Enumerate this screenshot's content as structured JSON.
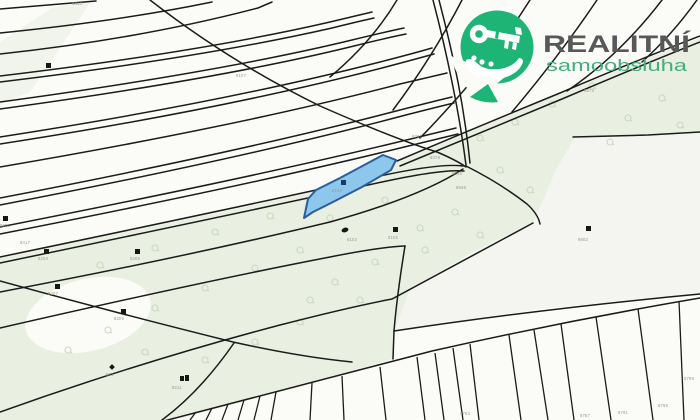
{
  "brand": {
    "name": "REALITNÍ",
    "subtitle": "samoobsluha",
    "logo_icon": "key-in-hand-icon"
  },
  "colors": {
    "background": "#fbfbf8",
    "land_green": "#e9efe1",
    "land_green_soft": "#eef2e6",
    "right_field_gray": "#f4f4f0",
    "line_dark": "#1b1b1b",
    "parcel_fill": "#8ec7ec",
    "parcel_stroke": "#2b5d9e",
    "parcel_marker": "#1d3a6e",
    "marker_black": "#161616",
    "label_gray": "#9a9a94",
    "veg_green": "#c9d6bb",
    "brand_green": "#1eb476",
    "brand_gray": "#58585a",
    "brand_subtitle_green": "#43ae7f"
  },
  "map": {
    "highlighted_parcel": {
      "label": "8106"
    },
    "parcel_labels": [
      {
        "text": "8313",
        "x": 72,
        "y": 5
      },
      {
        "text": "8107",
        "x": 236,
        "y": 77
      },
      {
        "text": "8737",
        "x": 412,
        "y": 138
      },
      {
        "text": "8379",
        "x": 430,
        "y": 159
      },
      {
        "text": "8635",
        "x": 452,
        "y": 175
      },
      {
        "text": "8596",
        "x": 456,
        "y": 189
      },
      {
        "text": "8573",
        "x": 584,
        "y": 92
      },
      {
        "text": "8802",
        "x": 578,
        "y": 241
      },
      {
        "text": "8106",
        "x": 332,
        "y": 192
      },
      {
        "text": "8103",
        "x": 347,
        "y": 241
      },
      {
        "text": "8105",
        "x": 388,
        "y": 239
      },
      {
        "text": "8417",
        "x": 20,
        "y": 244
      },
      {
        "text": "8201",
        "x": 0,
        "y": 227
      },
      {
        "text": "8203",
        "x": 38,
        "y": 260
      },
      {
        "text": "8205",
        "x": 130,
        "y": 260
      },
      {
        "text": "8207",
        "x": 48,
        "y": 295
      },
      {
        "text": "8209",
        "x": 114,
        "y": 320
      },
      {
        "text": "861",
        "x": 106,
        "y": 376
      },
      {
        "text": "8211",
        "x": 172,
        "y": 389
      },
      {
        "text": "8783",
        "x": 460,
        "y": 415
      },
      {
        "text": "8787",
        "x": 580,
        "y": 417
      },
      {
        "text": "8791",
        "x": 618,
        "y": 414
      },
      {
        "text": "8795",
        "x": 658,
        "y": 407
      },
      {
        "text": "8799",
        "x": 684,
        "y": 380
      }
    ],
    "building_markers": [
      {
        "kind": "square",
        "x": 46,
        "y": 63
      },
      {
        "kind": "square",
        "x": 3,
        "y": 216
      },
      {
        "kind": "square",
        "x": 44,
        "y": 249
      },
      {
        "kind": "square",
        "x": 135,
        "y": 249
      },
      {
        "kind": "square",
        "x": 55,
        "y": 284
      },
      {
        "kind": "square",
        "x": 121,
        "y": 309
      },
      {
        "kind": "double-square",
        "x": 180,
        "y": 376
      },
      {
        "kind": "navy-square",
        "x": 341,
        "y": 180
      },
      {
        "kind": "ellipse",
        "x": 345,
        "y": 230
      },
      {
        "kind": "square",
        "x": 393,
        "y": 227
      },
      {
        "kind": "square",
        "x": 586,
        "y": 226
      },
      {
        "kind": "diamond",
        "x": 110,
        "y": 365
      }
    ],
    "vegetation_symbols": [
      {
        "x": 100,
        "y": 265
      },
      {
        "x": 155,
        "y": 248
      },
      {
        "x": 215,
        "y": 232
      },
      {
        "x": 270,
        "y": 216
      },
      {
        "x": 330,
        "y": 218
      },
      {
        "x": 385,
        "y": 200
      },
      {
        "x": 300,
        "y": 250
      },
      {
        "x": 255,
        "y": 268
      },
      {
        "x": 205,
        "y": 288
      },
      {
        "x": 155,
        "y": 308
      },
      {
        "x": 108,
        "y": 330
      },
      {
        "x": 68,
        "y": 350
      },
      {
        "x": 335,
        "y": 282
      },
      {
        "x": 375,
        "y": 262
      },
      {
        "x": 420,
        "y": 228
      },
      {
        "x": 455,
        "y": 212
      },
      {
        "x": 425,
        "y": 250
      },
      {
        "x": 360,
        "y": 300
      },
      {
        "x": 300,
        "y": 322
      },
      {
        "x": 255,
        "y": 342
      },
      {
        "x": 480,
        "y": 138
      },
      {
        "x": 515,
        "y": 122
      },
      {
        "x": 552,
        "y": 104
      },
      {
        "x": 592,
        "y": 86
      },
      {
        "x": 628,
        "y": 118
      },
      {
        "x": 662,
        "y": 98
      },
      {
        "x": 610,
        "y": 142
      },
      {
        "x": 680,
        "y": 125
      },
      {
        "x": 145,
        "y": 352
      },
      {
        "x": 205,
        "y": 360
      },
      {
        "x": 310,
        "y": 300
      },
      {
        "x": 500,
        "y": 170
      },
      {
        "x": 530,
        "y": 190
      },
      {
        "x": 480,
        "y": 235
      }
    ]
  }
}
